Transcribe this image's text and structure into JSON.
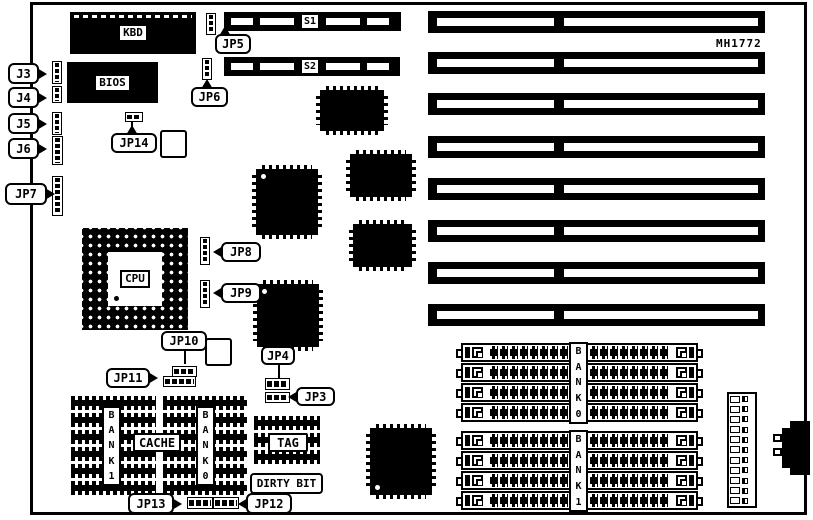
{
  "part_number": "MH1772",
  "components": {
    "keyboard_controller": "KBD",
    "bios": "BIOS",
    "cpu": "CPU",
    "cache": "CACHE",
    "tag": "TAG",
    "dirty_bit": "DIRTY BIT"
  },
  "slots": {
    "serial_1": "S1",
    "serial_2": "S2",
    "isa_slot_count": 8
  },
  "jumpers": {
    "j3": "J3",
    "j4": "J4",
    "j5": "J5",
    "j6": "J6",
    "jp3": "JP3",
    "jp4": "JP4",
    "jp5": "JP5",
    "jp6": "JP6",
    "jp7": "JP7",
    "jp8": "JP8",
    "jp9": "JP9",
    "jp10": "JP10",
    "jp11": "JP11",
    "jp12": "JP12",
    "jp13": "JP13",
    "jp14": "JP14"
  },
  "memory": {
    "cache_banks": [
      "BANK1",
      "BANK0"
    ],
    "simm_banks": [
      "BANK0",
      "BANK1"
    ],
    "simm_sockets_per_bank": 4
  }
}
